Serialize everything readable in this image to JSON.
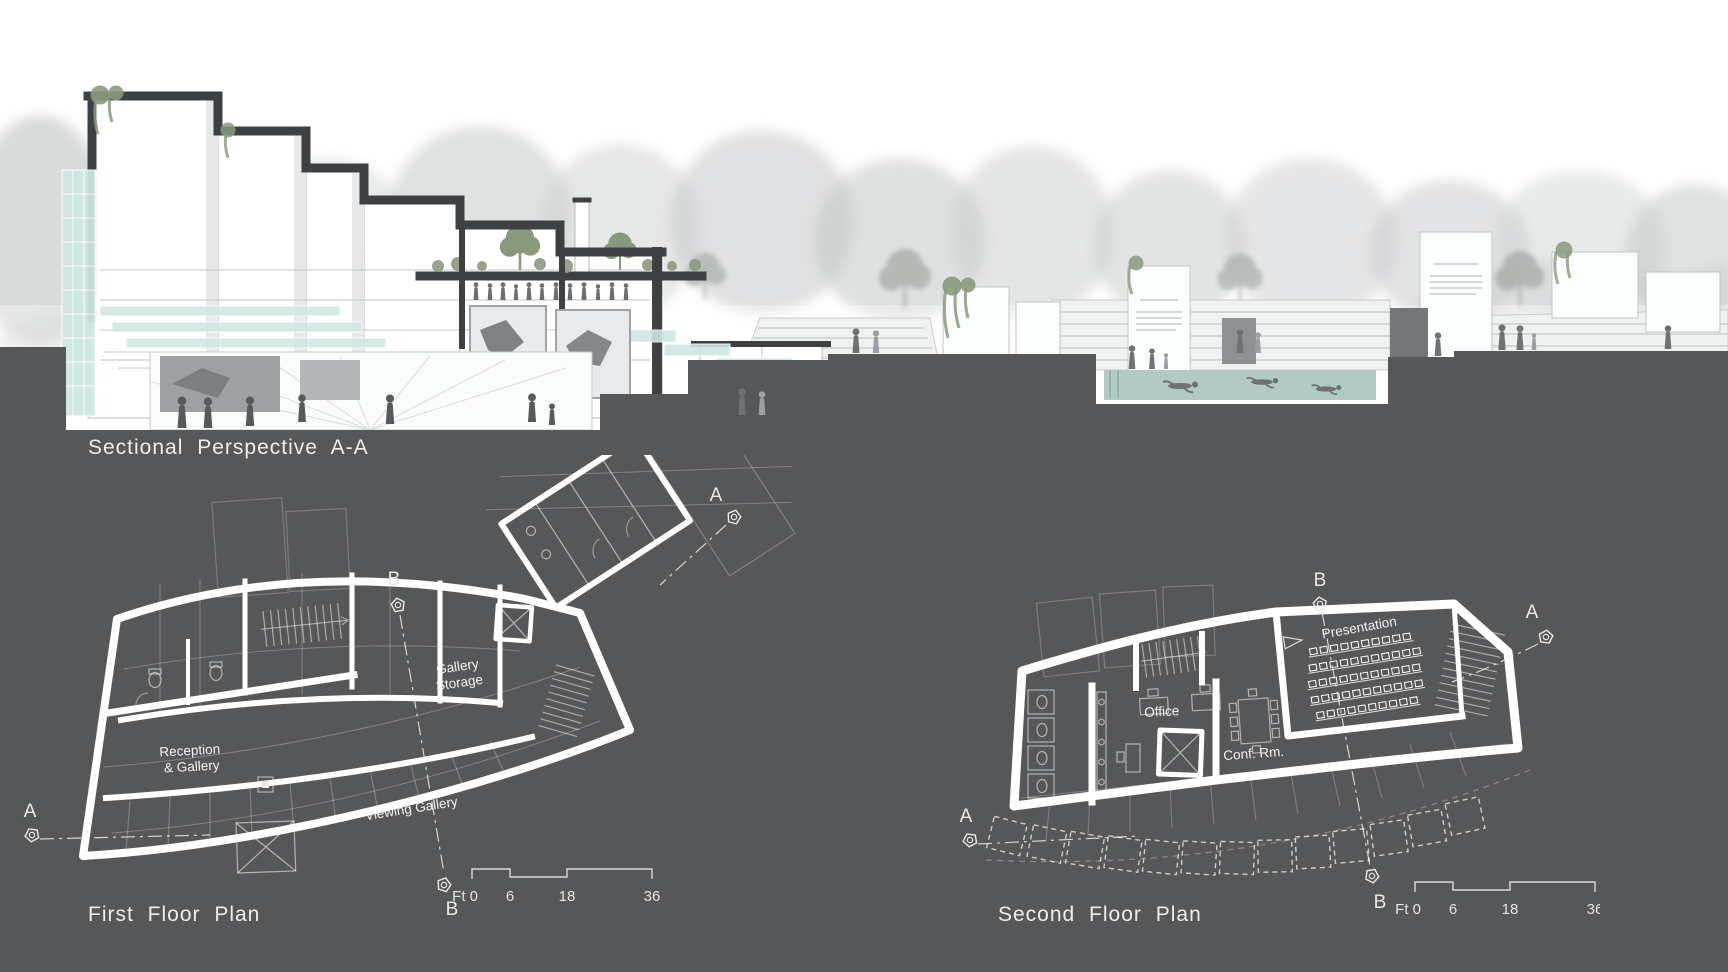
{
  "colors": {
    "ground": "#565759",
    "paper": "#ffffff",
    "poche": "#3e4144",
    "glass": "#cfe7e3",
    "water": "#b3c9c6",
    "vegetation": "#8b9a7e"
  },
  "section": {
    "title": "Sectional Perspective A-A"
  },
  "first_floor": {
    "title": "First Floor Plan",
    "rooms": {
      "gallery_storage_1": "Gallery",
      "gallery_storage_2": "Storage",
      "reception_1": "Reception",
      "reception_2": "& Gallery",
      "viewing_gallery": "Viewing Gallery"
    },
    "markers": {
      "a_top": "A",
      "b_top": "B",
      "a_left": "A",
      "b_bottom": "B"
    },
    "scale": {
      "zero": "Ft 0",
      "six": "6",
      "eighteen": "18",
      "thirtysix": "36"
    }
  },
  "second_floor": {
    "title": "Second Floor Plan",
    "rooms": {
      "presentation": "Presentation",
      "office": "Office",
      "conference": "Conf. Rm."
    },
    "markers": {
      "b_top": "B",
      "a_right": "A",
      "a_left": "A",
      "b_bottom": "B"
    },
    "scale": {
      "zero": "Ft 0",
      "six": "6",
      "eighteen": "18",
      "thirtysix": "36"
    }
  }
}
